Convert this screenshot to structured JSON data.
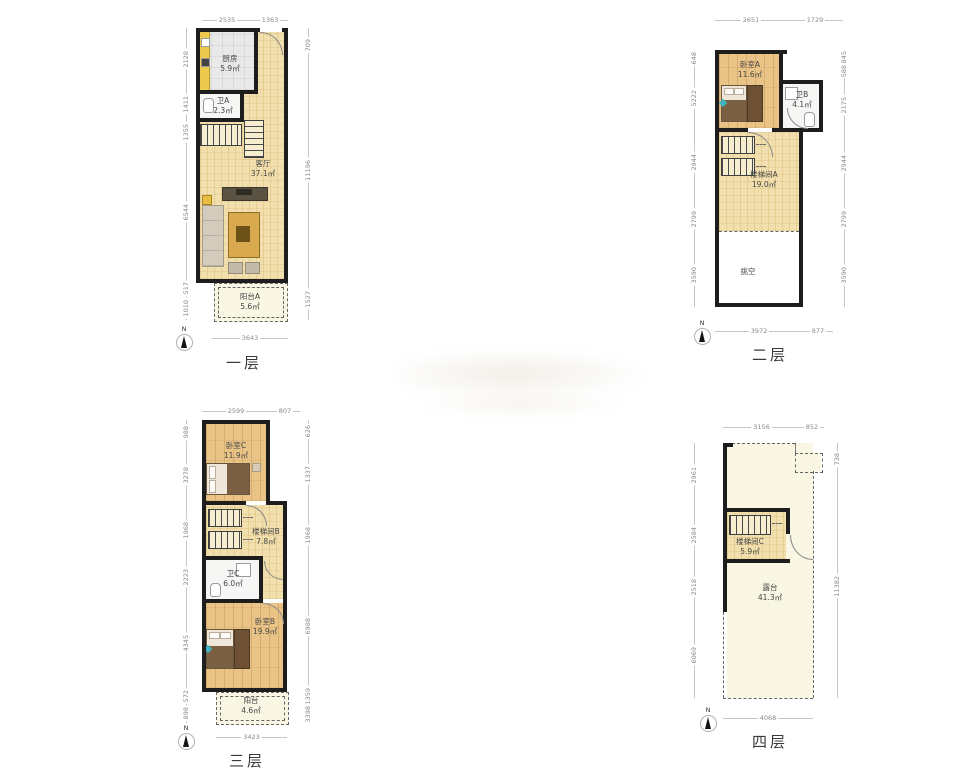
{
  "compass": {
    "north_label": "N"
  },
  "floors": [
    {
      "label": "一层",
      "rooms": [
        {
          "name": "厨房",
          "area": "5.9㎡"
        },
        {
          "name": "卫A",
          "area": "2.3㎡"
        },
        {
          "name": "客厅",
          "area": "37.1㎡"
        },
        {
          "name": "阳台A",
          "area": "5.6㎡"
        }
      ],
      "dims": {
        "top": [
          "2535",
          "1363"
        ],
        "left": [
          "2128",
          "1411",
          "1355",
          "6544",
          "517",
          "1010"
        ],
        "right": [
          "709",
          "11196",
          "1527"
        ],
        "bottom": [
          "3643"
        ]
      }
    },
    {
      "label": "二层",
      "rooms": [
        {
          "name": "卧室A",
          "area": "11.6㎡"
        },
        {
          "name": "卫B",
          "area": "4.1㎡"
        },
        {
          "name": "楼梯间A",
          "area": "19.0㎡"
        },
        {
          "name": "挑空",
          "area": ""
        }
      ],
      "dims": {
        "top": [
          "2651",
          "1729"
        ],
        "left": [
          "648",
          "5222",
          "2944",
          "2799",
          "3590"
        ],
        "right": [
          "845",
          "588",
          "2175",
          "2944",
          "2799",
          "3590"
        ],
        "bottom": [
          "3972",
          "877"
        ]
      }
    },
    {
      "label": "三层",
      "rooms": [
        {
          "name": "卧室C",
          "area": "11.9㎡"
        },
        {
          "name": "楼梯间B",
          "area": "7.8㎡"
        },
        {
          "name": "卫C",
          "area": "6.0㎡"
        },
        {
          "name": "卧室B",
          "area": "19.9㎡"
        },
        {
          "name": "阳台",
          "area": "4.6㎡"
        }
      ],
      "dims": {
        "top": [
          "2599",
          "807"
        ],
        "left": [
          "988",
          "3278",
          "1968",
          "2223",
          "4345",
          "572",
          "898"
        ],
        "right": [
          "626",
          "1337",
          "1968",
          "6988",
          "1359",
          "3398"
        ],
        "bottom": [
          "3423"
        ]
      }
    },
    {
      "label": "四层",
      "rooms": [
        {
          "name": "楼梯间C",
          "area": "5.9㎡"
        },
        {
          "name": "露台",
          "area": "41.3㎡"
        }
      ],
      "dims": {
        "top": [
          "3156",
          "852"
        ],
        "left": [
          "2961",
          "2584",
          "2518",
          "6069"
        ],
        "right": [
          "738",
          "11382"
        ],
        "bottom": [
          "4068"
        ]
      }
    }
  ]
}
